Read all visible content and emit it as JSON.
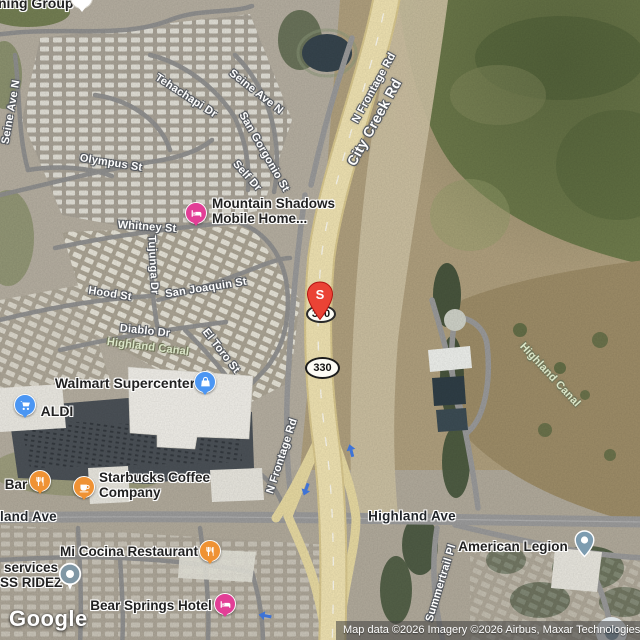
{
  "attribution": "Map data ©2026 Imagery ©2026 Airbus, Maxar Technologies",
  "google_logo": "Google",
  "markers": {
    "s_pin_label": "S",
    "route_shield": "330"
  },
  "colors": {
    "destination_pin": "#ea4335",
    "shopping_icon": "#4b96f3",
    "food_icon": "#ef9234",
    "lodging_icon": "#e23e96",
    "generic_pin": "#7d9cb0",
    "highway_fill": "#f0e3b2"
  },
  "road_labels": {
    "seine_ave_n_west": "Seine Ave N",
    "tehachapi_dr": "Tehachapi Dr",
    "seine_ave_n_east": "Seine Ave N",
    "san_gorgonio_st": "San Gorgonio St",
    "self_dr": "Self Dr",
    "olympus_st": "Olympus St",
    "whitney_st": "Whitney St",
    "tujunga_dr": "Tujunga Dr",
    "san_joaquin_st": "San Joaquin St",
    "hood_st": "Hood St",
    "diablo_dr": "Diablo Dr",
    "el_toro_st": "El Toro St",
    "n_frontage_rd_north": "N Frontage Rd",
    "city_creek_rd": "City Creek Rd",
    "n_frontage_rd_south": "N Frontage Rd",
    "highland_ave": "Highland Ave",
    "highland_ave_cut": "land Ave",
    "summertrail_pl": "Summertrail Pl",
    "highland_canal_west": "Highland Canal",
    "highland_canal_east": "Highland Canal"
  },
  "pois": {
    "ning_group": "ning Group",
    "mountain_shadows_line1": "Mountain Shadows",
    "mountain_shadows_line2": "Mobile Home...",
    "walmart": "Walmart Supercenter",
    "aldi": "ALDI",
    "bar": "Bar",
    "starbucks_line1": "Starbucks Coffee",
    "starbucks_line2": "Company",
    "services_line1": "services",
    "services_line2": "SS RIDEZ",
    "mi_cocina": "Mi Cocina Restaurant",
    "bear_springs": "Bear Springs Hotel",
    "american_legion": "American Legion"
  }
}
